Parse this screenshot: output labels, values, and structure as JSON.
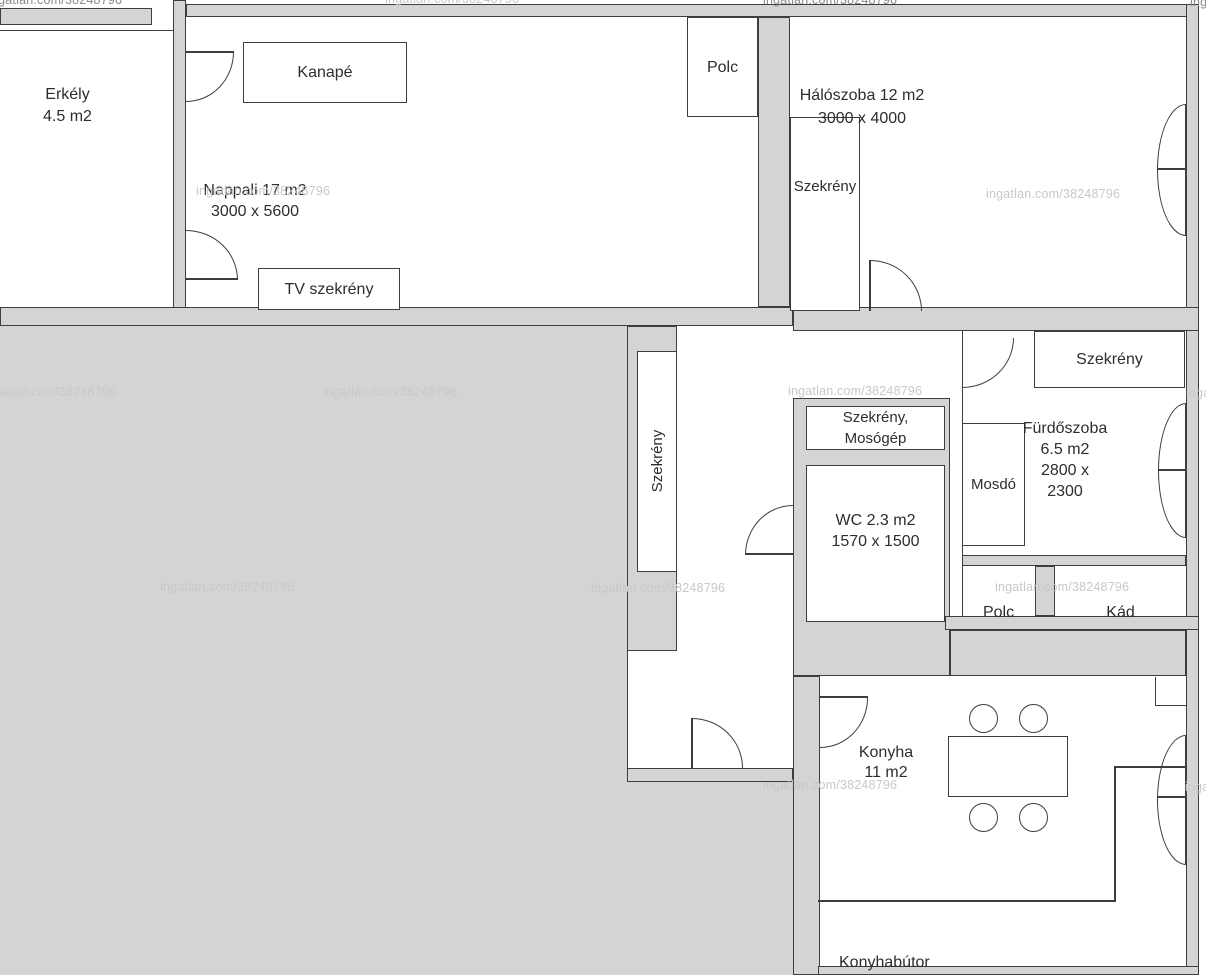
{
  "watermark": {
    "text": "ingatlan.com/38248796"
  },
  "labels": {
    "balcony_name": "Erkély",
    "balcony_area": "4.5 m2",
    "sofa": "Kanapé",
    "living_name": "Nappali 17 m2",
    "living_dims": "3000 x 5600",
    "tv_cabinet": "TV szekrény",
    "shelf_top": "Polc",
    "bedroom_name": "Hálószoba 12 m2",
    "bedroom_dims": "3000 x 4000",
    "wardrobe_bedroom": "Szekrény",
    "wardrobe_hall": "Szekrény",
    "wardrobe_washer_line1": "Szekrény,",
    "wardrobe_washer_line2": "Mosógép",
    "wc_name": "WC 2.3 m2",
    "wc_dims": "1570 x 1500",
    "sink": "Mosdó",
    "bathroom_name": "Fürdőszoba",
    "bathroom_area": "6.5 m2",
    "bathroom_dims_line1": "2800 x",
    "bathroom_dims_line2": "2300",
    "wardrobe_bathroom": "Szekrény",
    "shelf_bathroom": "Polc",
    "bathtub": "Kád",
    "kitchen_name": "Konyha",
    "kitchen_area": "11 m2",
    "kitchen_furniture": "Konyhabútor"
  },
  "colors": {
    "wall": "#d4d4d4",
    "line": "#3e3e3e",
    "text": "#2d2d2d",
    "wmL": "#c8c8c8",
    "wmD": "#8a8a8a"
  }
}
